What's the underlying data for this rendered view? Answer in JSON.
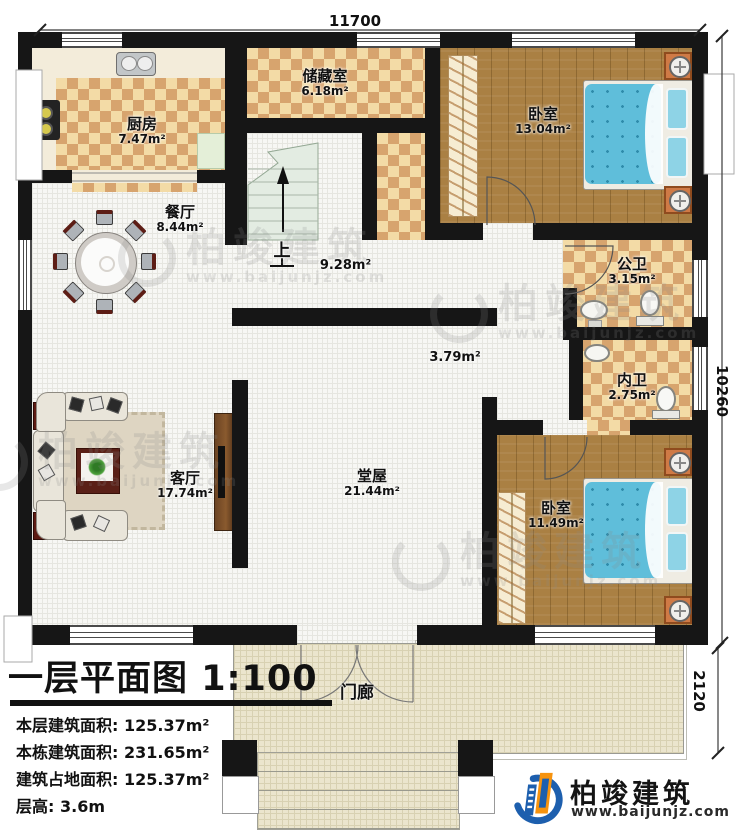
{
  "dims": {
    "width": "11700",
    "height": "10260",
    "porch_depth": "2120"
  },
  "rooms": {
    "kitchen": {
      "name": "厨房",
      "area": "7.47m²"
    },
    "storage": {
      "name": "储藏室",
      "area": "6.18m²"
    },
    "bedroom1": {
      "name": "卧室",
      "area": "13.04m²"
    },
    "dining": {
      "name": "餐厅",
      "area": "8.44m²"
    },
    "stair_hall": {
      "area": "9.28m²"
    },
    "public_bath": {
      "name": "公卫",
      "area": "3.15m²"
    },
    "inner_corridor": {
      "area": "3.79m²"
    },
    "private_bath": {
      "name": "内卫",
      "area": "2.75m²"
    },
    "living": {
      "name": "客厅",
      "area": "17.74m²"
    },
    "hall": {
      "name": "堂屋",
      "area": "21.44m²"
    },
    "bedroom2": {
      "name": "卧室",
      "area": "11.49m²"
    },
    "porch": {
      "name": "门廊"
    }
  },
  "stairs": {
    "up": "上"
  },
  "title_block": {
    "title": "一层平面图",
    "scale": "1:100",
    "info": [
      {
        "label": "本层建筑面积:",
        "value": "125.37m²"
      },
      {
        "label": "本栋建筑面积:",
        "value": "231.65m²"
      },
      {
        "label": "建筑占地面积:",
        "value": "125.37m²"
      },
      {
        "label": "层高:",
        "value": "3.6m"
      }
    ]
  },
  "brand": {
    "name": "柏竣建筑",
    "site": "www.baijunjz.com"
  },
  "watermark": {
    "text": "柏竣建筑",
    "site": "www.baijunjz.com"
  },
  "colors": {
    "wall": "#161616",
    "checker_light": "#f3dba6",
    "checker_dark": "#d7a46e",
    "wood_floor": "#aa8043",
    "bed_blue": "#5fbeda",
    "brand_blue": "#1d5fae",
    "brand_orange": "#f6930f"
  }
}
